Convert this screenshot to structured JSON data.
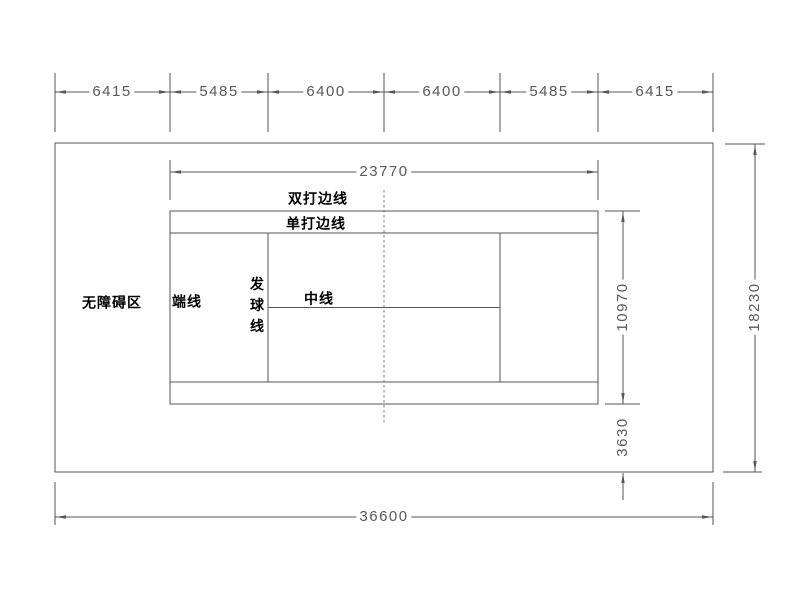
{
  "dimensions": {
    "top_segments": [
      "6415",
      "5485",
      "6400",
      "6400",
      "5485",
      "6415"
    ],
    "court_length": "23770",
    "court_width": "10970",
    "side_runoff": "3630",
    "total_length": "36600",
    "total_width": "18230"
  },
  "labels": {
    "doubles_sideline": "双打边线",
    "singles_sideline": "单打边线",
    "baseline": "端线",
    "service_line": "发球线",
    "center_line": "中线",
    "clear_zone": "无障碍区"
  },
  "colors": {
    "line": "#555555",
    "dim_text": "#595959",
    "label_text": "#000000",
    "background": "#ffffff"
  }
}
